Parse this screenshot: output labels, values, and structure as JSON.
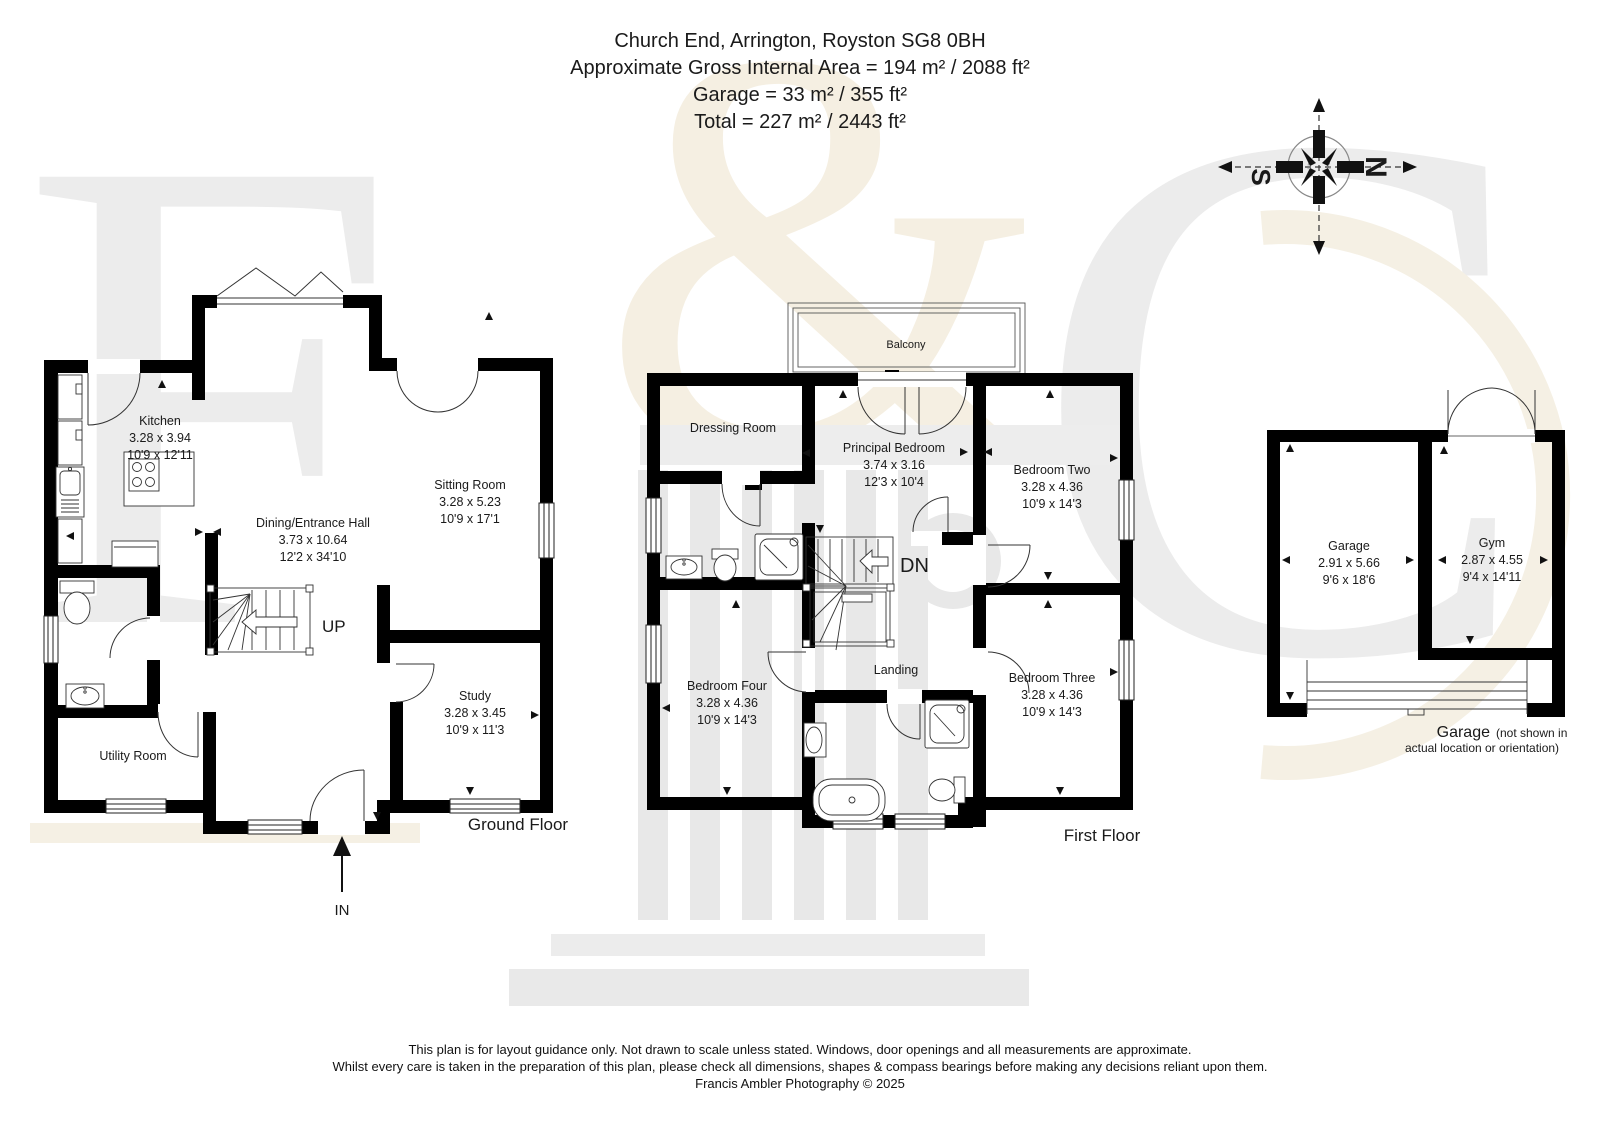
{
  "header": {
    "address": "Church End, Arrington, Royston SG8 0BH",
    "area_line": "Approximate Gross Internal Area = 194 m² / 2088 ft²",
    "garage_line": "Garage = 33 m² / 355 ft²",
    "total_line": "Total = 227 m² / 2443 ft²"
  },
  "compass": {
    "north": "N",
    "south": "S"
  },
  "watermark": {
    "letter_f": "F",
    "letter_amp": "&",
    "letter_c": "C"
  },
  "ground_floor": {
    "floor_label": "Ground Floor",
    "stairs_label": "UP",
    "entrance_label": "IN",
    "rooms": {
      "kitchen": {
        "name": "Kitchen",
        "metric": "3.28 x 3.94",
        "imperial": "10'9 x 12'11"
      },
      "dining": {
        "name": "Dining/Entrance Hall",
        "metric": "3.73 x 10.64",
        "imperial": "12'2 x 34'10"
      },
      "sitting": {
        "name": "Sitting Room",
        "metric": "3.28 x 5.23",
        "imperial": "10'9 x 17'1"
      },
      "study": {
        "name": "Study",
        "metric": "3.28 x 3.45",
        "imperial": "10'9 x 11'3"
      },
      "utility": {
        "name": "Utility Room"
      }
    }
  },
  "first_floor": {
    "floor_label": "First Floor",
    "stairs_label": "DN",
    "rooms": {
      "balcony": {
        "name": "Balcony"
      },
      "dressing": {
        "name": "Dressing Room"
      },
      "principal": {
        "name": "Principal Bedroom",
        "metric": "3.74 x 3.16",
        "imperial": "12'3 x 10'4"
      },
      "bedroom_two": {
        "name": "Bedroom Two",
        "metric": "3.28 x 4.36",
        "imperial": "10'9 x 14'3"
      },
      "bedroom_three": {
        "name": "Bedroom Three",
        "metric": "3.28 x 4.36",
        "imperial": "10'9 x 14'3"
      },
      "bedroom_four": {
        "name": "Bedroom Four",
        "metric": "3.28 x 4.36",
        "imperial": "10'9 x 14'3"
      },
      "landing": {
        "name": "Landing"
      }
    }
  },
  "garage_block": {
    "rooms": {
      "garage": {
        "name": "Garage",
        "metric": "2.91 x 5.66",
        "imperial": "9'6 x 18'6"
      },
      "gym": {
        "name": "Gym",
        "metric": "2.87 x 4.55",
        "imperial": "9'4 x 14'11"
      }
    },
    "caption_title": "Garage",
    "caption_note1": "(not shown in",
    "caption_note2": "actual location or orientation)"
  },
  "footer": {
    "line1": "This plan is for layout guidance only. Not drawn to scale unless stated. Windows, door openings and all measurements are approximate.",
    "line2": "Whilst every care is taken in the preparation of this plan, please check all dimensions, shapes & compass bearings before making any decisions reliant upon them.",
    "line3": "Francis Ambler Photography © 2025"
  }
}
